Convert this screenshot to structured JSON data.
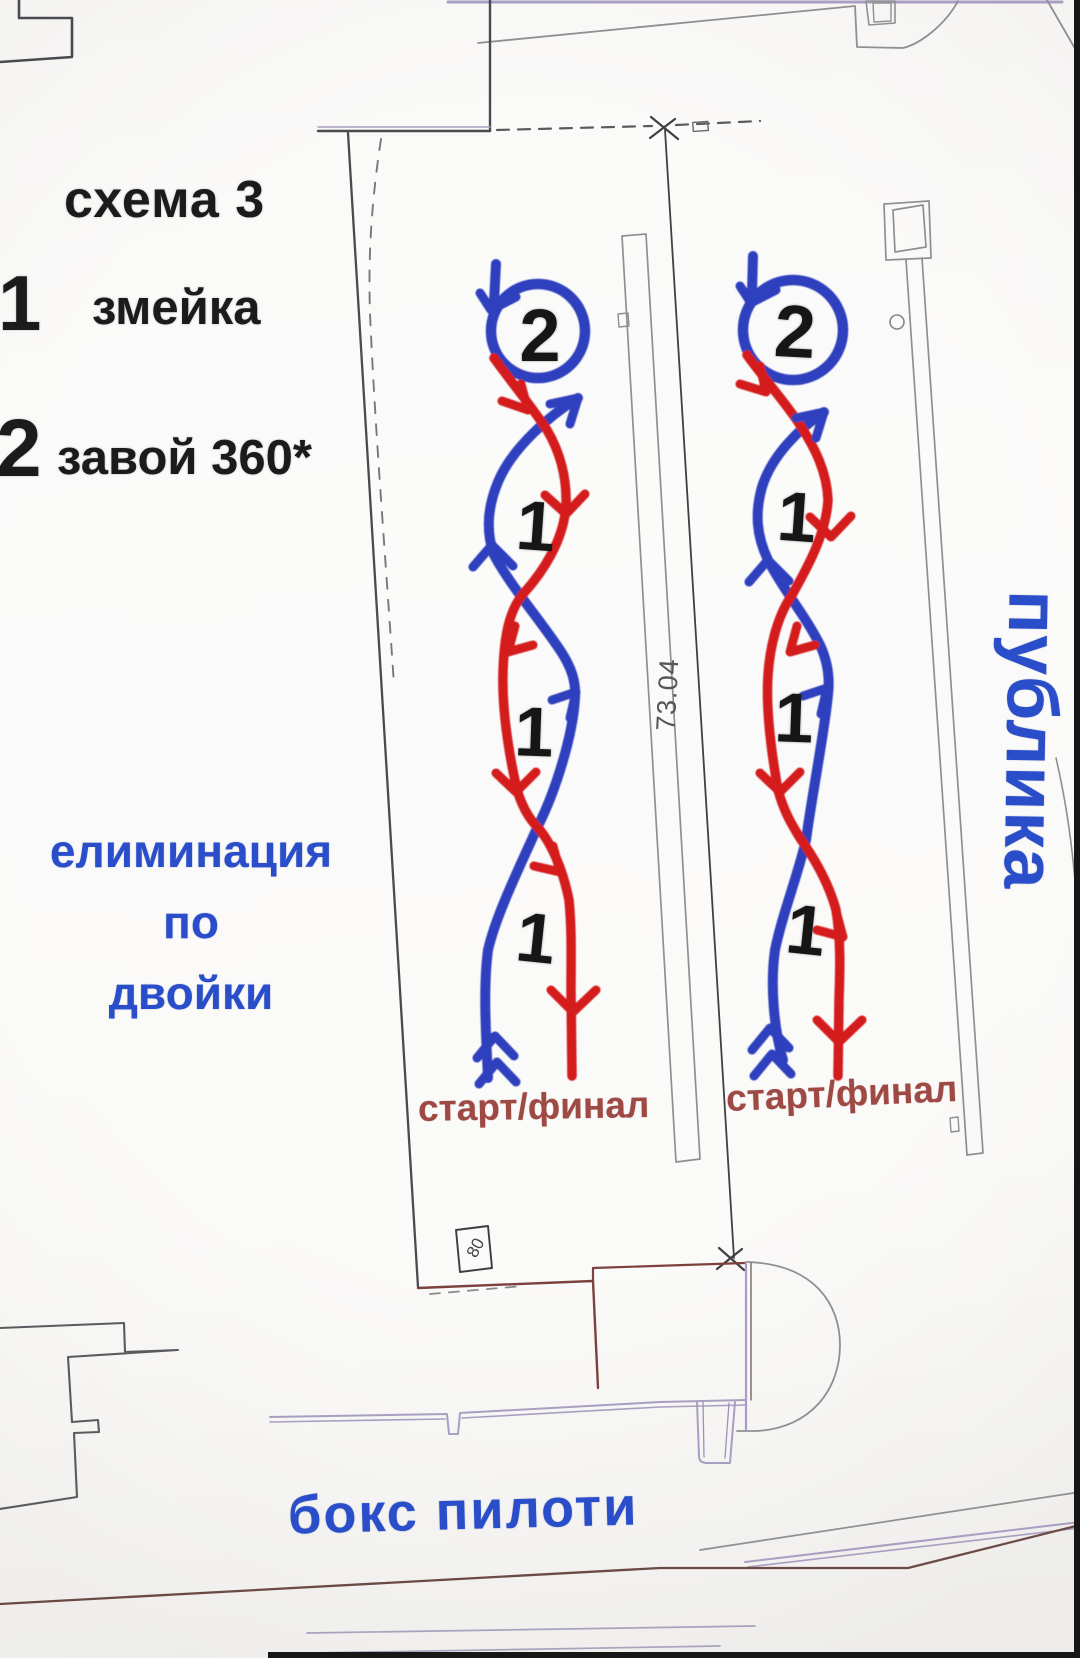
{
  "title": "схема 3",
  "legend": [
    {
      "num": "1",
      "label": "змейка"
    },
    {
      "num": "2",
      "label": "завой 360*"
    }
  ],
  "elimination_note": {
    "line1": "елиминация",
    "line2": "по",
    "line3": "двойки"
  },
  "audience_label": "публика",
  "pits_label": "бокс пилоти",
  "dimension_value": "73.04",
  "gate_box_label": "80",
  "start_finish": {
    "left": "старт/финал",
    "right": "старт/финал"
  },
  "serpentines": {
    "left": {
      "numbers": [
        "2",
        "1",
        "1",
        "1"
      ]
    },
    "right": {
      "numbers": [
        "2",
        "1",
        "1",
        "1"
      ]
    }
  },
  "colors": {
    "annotation-blue": "#2f3fbe",
    "annotation-red": "#d41e1e",
    "note-blue": "#2a4ec9",
    "start-finish": "#9e4944",
    "ink": "#1b1b1b",
    "map-gray": "#8f8f93",
    "map-dark": "#4a4a50",
    "map-purple": "#a89ec2",
    "map-redbrown": "#7d403c"
  }
}
